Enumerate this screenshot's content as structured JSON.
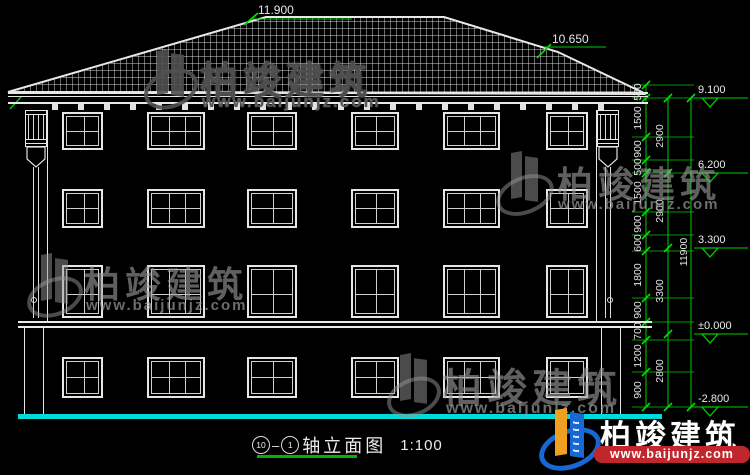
{
  "drawing": {
    "type_label": "建筑立面图",
    "top_levels": [
      "11.900",
      "10.650"
    ],
    "dimensions": {
      "col1": [
        "500",
        "1500",
        "900",
        "500",
        "1500",
        "900",
        "600",
        "1800",
        "900",
        "700",
        "1200",
        "900"
      ],
      "col2": [
        "2900",
        "2900",
        "3300",
        "2800"
      ],
      "col3": [
        "11900"
      ],
      "levels": [
        "9.100",
        "6.200",
        "3.300",
        "±0.000",
        "-2.800"
      ]
    }
  },
  "title": {
    "axis_start": "10",
    "separator": "–",
    "axis_end": "1",
    "name": "轴立面图",
    "scale": "1:100"
  },
  "watermark": {
    "brand": "柏竣建筑",
    "url": "www.baijunjz.com"
  },
  "colors": {
    "background": "#000000",
    "linework": "#e8e8e8",
    "dimension_green": "#00cc00",
    "ground_cyan": "#00dcdc",
    "logo_blue": "#1668d6",
    "logo_orange": "#f0a020",
    "banner_red": "#c0272d"
  }
}
